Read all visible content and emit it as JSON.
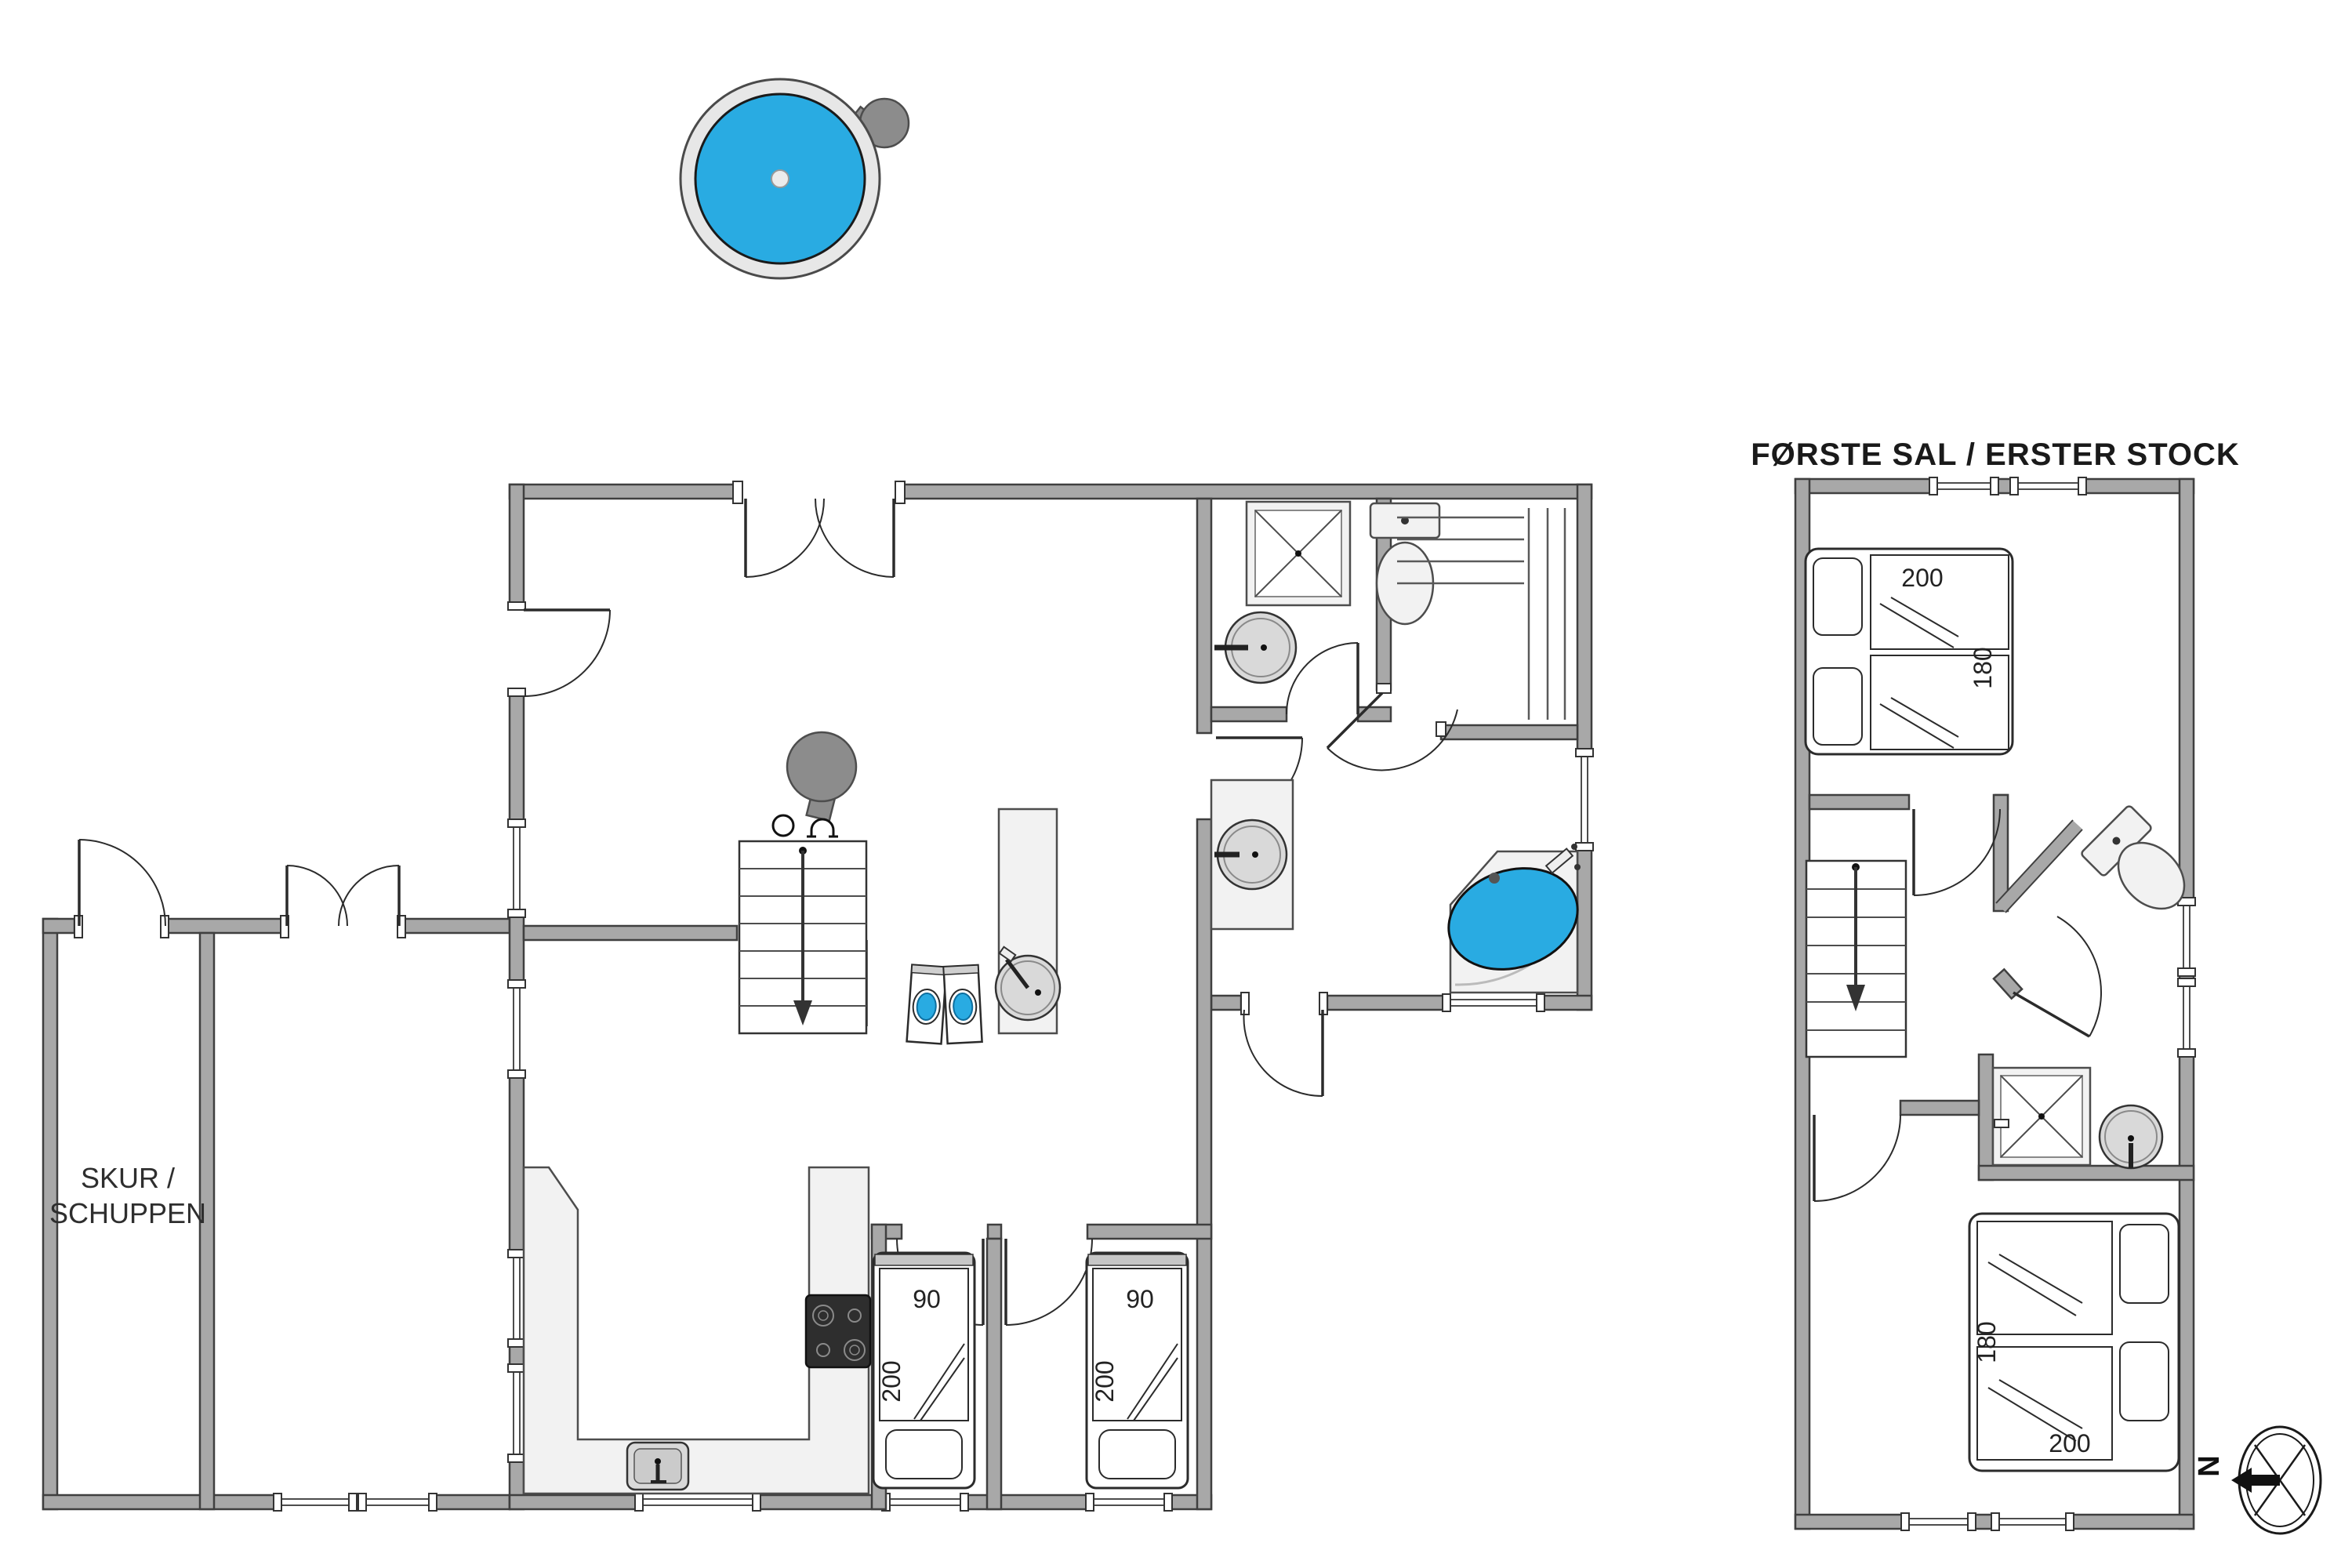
{
  "labels": {
    "shed_line1": "SKUR /",
    "shed_line2": "SCHUPPEN",
    "upper_floor_title": "FØRSTE SAL / ERSTER STOCK",
    "compass_n": "N"
  },
  "dimensions": {
    "single_bed_width": "90",
    "single_bed_length": "200",
    "double_bed_width": "180",
    "double_bed_length": "200"
  },
  "colors": {
    "water_blue": "#29ABE2",
    "wall_gray": "#A8A8A8",
    "fixture_gray": "#F2F2F2",
    "appliance_gray": "#8C8C8C",
    "cooktop_black": "#2E2E2E",
    "label_dark": "#222222"
  }
}
